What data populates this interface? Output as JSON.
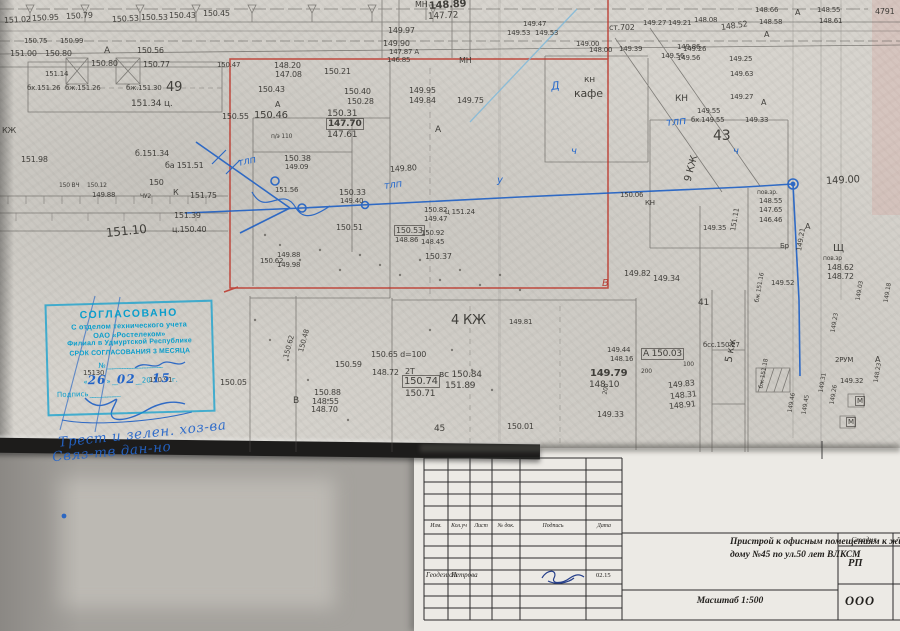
{
  "doc": {
    "type_note": "scanned topographic survey plan 1:500 with approval stamp and title block"
  },
  "stamp": {
    "lines": [
      "СОГЛАСОВАНО",
      "С отделом технического учета",
      "ОАО «Ростелеком»",
      "Филиал в Удмуртской Республике",
      "СРОК СОГЛАСОВАНИЯ 3 МЕСЯЦА"
    ],
    "number_label": "№",
    "date": {
      "open": "«",
      "day": "26",
      "close": "»",
      "month": "02",
      "century": "20",
      "year": "15",
      "suffix": "г."
    },
    "sign_label": "Подпись"
  },
  "notes": [
    {
      "t": "Трест и зелен. хоз-ва",
      "x": 58,
      "y": 426,
      "r": -6
    },
    {
      "t": "Связ-тв  дан-но",
      "x": 52,
      "y": 444,
      "r": -5
    }
  ],
  "titleblock": {
    "columns": [
      "Изм.",
      "Кол.уч",
      "Лист",
      "№ док.",
      "Подпись",
      "Дата"
    ],
    "row": {
      "role": "Геодезист",
      "name": "Петрова",
      "date": "02.15"
    },
    "title_line1": "Пристрой к офисным помещениям к жилому",
    "title_line2": "дому №45 по ул.50 лет ВЛКСМ",
    "scale": "Масштаб 1:500",
    "stage_label": "Стадия",
    "stage_value": "РП",
    "org": "ООО",
    "sheet_col": "Л"
  },
  "map": {
    "labels": [
      {
        "t": "151.02",
        "x": 4,
        "y": 16,
        "r": -3
      },
      {
        "t": "150.95",
        "x": 32,
        "y": 14,
        "r": -3
      },
      {
        "t": "150.79",
        "x": 66,
        "y": 12,
        "r": -3
      },
      {
        "t": "150.53",
        "x": 112,
        "y": 15,
        "r": -3
      },
      {
        "t": "150.53",
        "x": 141,
        "y": 13
      },
      {
        "t": "150.43",
        "x": 169,
        "y": 11
      },
      {
        "t": "150.45",
        "x": 203,
        "y": 9
      },
      {
        "t": "150.75",
        "x": 24,
        "y": 37,
        "s": 7
      },
      {
        "t": "150.99",
        "x": 60,
        "y": 37,
        "s": 7
      },
      {
        "t": "151.00",
        "x": 10,
        "y": 49
      },
      {
        "t": "150.80",
        "x": 45,
        "y": 49
      },
      {
        "t": "А",
        "x": 104,
        "y": 46,
        "s": 9
      },
      {
        "t": "150.56",
        "x": 137,
        "y": 46
      },
      {
        "t": "150.80",
        "x": 91,
        "y": 59
      },
      {
        "t": "150.77",
        "x": 143,
        "y": 60
      },
      {
        "t": "151.14",
        "x": 45,
        "y": 70,
        "s": 7
      },
      {
        "t": "бх.151.26",
        "x": 27,
        "y": 84,
        "s": 7
      },
      {
        "t": "бж.151.26",
        "x": 65,
        "y": 84,
        "s": 7
      },
      {
        "t": "бж.151.30",
        "x": 126,
        "y": 84,
        "s": 7
      },
      {
        "t": "49",
        "x": 166,
        "y": 80,
        "s": 13
      },
      {
        "t": "151.34 ц.",
        "x": 131,
        "y": 99,
        "s": 9
      },
      {
        "t": "КЖ",
        "x": 2,
        "y": 126
      },
      {
        "t": "МН",
        "x": 415,
        "y": 0
      },
      {
        "t": "148.89",
        "x": 429,
        "y": 1,
        "s": 10,
        "w": 1,
        "r": -4
      },
      {
        "t": "147.72",
        "x": 428,
        "y": 12,
        "s": 9,
        "r": -3
      },
      {
        "t": "149.97",
        "x": 388,
        "y": 26
      },
      {
        "t": "149.90",
        "x": 383,
        "y": 39
      },
      {
        "t": "147.87 А",
        "x": 389,
        "y": 48,
        "s": 7
      },
      {
        "t": "146.85",
        "x": 387,
        "y": 56,
        "s": 7
      },
      {
        "t": "МН",
        "x": 459,
        "y": 56
      },
      {
        "t": "149.47",
        "x": 523,
        "y": 20,
        "s": 7
      },
      {
        "t": "149.53",
        "x": 507,
        "y": 29,
        "s": 7
      },
      {
        "t": "149.53",
        "x": 535,
        "y": 29,
        "s": 7
      },
      {
        "t": "ст.702",
        "x": 609,
        "y": 23,
        "s": 8
      },
      {
        "t": "149.00",
        "x": 576,
        "y": 40,
        "s": 7
      },
      {
        "t": "148.00",
        "x": 589,
        "y": 46,
        "s": 7
      },
      {
        "t": "149.39",
        "x": 619,
        "y": 45,
        "s": 7
      },
      {
        "t": "149.86",
        "x": 677,
        "y": 43,
        "s": 7
      },
      {
        "t": "149.56",
        "x": 661,
        "y": 52,
        "s": 7
      },
      {
        "t": "149.27",
        "x": 643,
        "y": 19,
        "s": 7
      },
      {
        "t": "149.21",
        "x": 668,
        "y": 19,
        "s": 7
      },
      {
        "t": "148.08",
        "x": 694,
        "y": 16,
        "s": 7
      },
      {
        "t": "148.52",
        "x": 721,
        "y": 23,
        "r": -8
      },
      {
        "t": "148.58",
        "x": 759,
        "y": 18,
        "s": 7
      },
      {
        "t": "148.66",
        "x": 755,
        "y": 6,
        "s": 7
      },
      {
        "t": "А",
        "x": 795,
        "y": 8
      },
      {
        "t": "148.55",
        "x": 817,
        "y": 6,
        "s": 7
      },
      {
        "t": "148.61",
        "x": 819,
        "y": 17,
        "s": 7
      },
      {
        "t": "4791",
        "x": 875,
        "y": 7
      },
      {
        "t": "149.26",
        "x": 683,
        "y": 45,
        "s": 7
      },
      {
        "t": "149.56",
        "x": 677,
        "y": 54,
        "s": 7
      },
      {
        "t": "А",
        "x": 764,
        "y": 30
      },
      {
        "t": "150.47",
        "x": 217,
        "y": 61,
        "s": 7
      },
      {
        "t": "148.20",
        "x": 274,
        "y": 61
      },
      {
        "t": "147.08",
        "x": 275,
        "y": 70
      },
      {
        "t": "150.21",
        "x": 324,
        "y": 67
      },
      {
        "t": "150.43",
        "x": 258,
        "y": 85
      },
      {
        "t": "150.40",
        "x": 344,
        "y": 87
      },
      {
        "t": "150.28",
        "x": 347,
        "y": 97
      },
      {
        "t": "149.95",
        "x": 409,
        "y": 86
      },
      {
        "t": "149.84",
        "x": 409,
        "y": 96
      },
      {
        "t": "149.75",
        "x": 457,
        "y": 96
      },
      {
        "t": "А",
        "x": 275,
        "y": 100
      },
      {
        "t": "А",
        "x": 435,
        "y": 125,
        "s": 9
      },
      {
        "t": "150.55",
        "x": 222,
        "y": 112
      },
      {
        "t": "150.46",
        "x": 254,
        "y": 110,
        "s": 10
      },
      {
        "t": "150.31",
        "x": 327,
        "y": 109,
        "s": 9
      },
      {
        "t": "147.70",
        "x": 327,
        "y": 119,
        "s": 9,
        "w": 1,
        "b": 1
      },
      {
        "t": "147.61",
        "x": 327,
        "y": 130,
        "s": 9
      },
      {
        "t": "п/э 110",
        "x": 271,
        "y": 133,
        "s": 6
      },
      {
        "t": "150.38",
        "x": 284,
        "y": 154
      },
      {
        "t": "149.09",
        "x": 285,
        "y": 163,
        "s": 7
      },
      {
        "t": "151.56",
        "x": 275,
        "y": 186,
        "s": 7
      },
      {
        "t": "150.33",
        "x": 339,
        "y": 188
      },
      {
        "t": "149.40",
        "x": 340,
        "y": 197,
        "s": 7
      },
      {
        "t": "149.80",
        "x": 390,
        "y": 165,
        "r": -4
      },
      {
        "t": "ц 151.24",
        "x": 445,
        "y": 208,
        "s": 7
      },
      {
        "t": "150.51",
        "x": 336,
        "y": 223
      },
      {
        "t": "150.53",
        "x": 395,
        "y": 226,
        "b": 1
      },
      {
        "t": "148.86",
        "x": 395,
        "y": 236,
        "s": 7
      },
      {
        "t": "150.82",
        "x": 424,
        "y": 206,
        "s": 7
      },
      {
        "t": "149.47",
        "x": 424,
        "y": 215,
        "s": 7
      },
      {
        "t": "150.92",
        "x": 421,
        "y": 229,
        "s": 7
      },
      {
        "t": "148.45",
        "x": 421,
        "y": 238,
        "s": 7
      },
      {
        "t": "150.37",
        "x": 425,
        "y": 252
      },
      {
        "t": "150.62",
        "x": 260,
        "y": 257,
        "s": 7
      },
      {
        "t": "149.88",
        "x": 277,
        "y": 251,
        "s": 7
      },
      {
        "t": "149.98",
        "x": 277,
        "y": 261,
        "s": 7
      },
      {
        "t": "В",
        "x": 602,
        "y": 278,
        "s": 10,
        "c": "red"
      },
      {
        "t": "кн",
        "x": 584,
        "y": 75,
        "s": 9
      },
      {
        "t": "кафе",
        "x": 574,
        "y": 87,
        "s": 11
      },
      {
        "t": "КН",
        "x": 675,
        "y": 94,
        "s": 9
      },
      {
        "t": "149.55",
        "x": 697,
        "y": 107,
        "s": 7
      },
      {
        "t": "бх.149.55",
        "x": 691,
        "y": 116,
        "s": 7
      },
      {
        "t": "149.33",
        "x": 745,
        "y": 116,
        "s": 7
      },
      {
        "t": "43",
        "x": 713,
        "y": 128,
        "s": 14
      },
      {
        "t": "149.63",
        "x": 730,
        "y": 70,
        "s": 7
      },
      {
        "t": "149.27",
        "x": 730,
        "y": 93,
        "s": 7
      },
      {
        "t": "149.25",
        "x": 729,
        "y": 55,
        "s": 7
      },
      {
        "t": "А",
        "x": 761,
        "y": 98
      },
      {
        "t": "9 КЖ",
        "x": 688,
        "y": 176,
        "r": -75,
        "s": 10
      },
      {
        "t": "150.06",
        "x": 620,
        "y": 191,
        "s": 7
      },
      {
        "t": "КН",
        "x": 645,
        "y": 199,
        "s": 7
      },
      {
        "t": "149.35",
        "x": 703,
        "y": 224,
        "s": 7
      },
      {
        "t": "пов.зр.",
        "x": 757,
        "y": 189,
        "s": 6
      },
      {
        "t": "148.55",
        "x": 759,
        "y": 197,
        "s": 7
      },
      {
        "t": "147.65",
        "x": 759,
        "y": 206,
        "s": 7
      },
      {
        "t": "146.46",
        "x": 759,
        "y": 216,
        "s": 7
      },
      {
        "t": "149.00",
        "x": 826,
        "y": 176,
        "s": 10,
        "r": -3
      },
      {
        "t": "151.11",
        "x": 733,
        "y": 227,
        "r": -80,
        "s": 7
      },
      {
        "t": "Бр",
        "x": 780,
        "y": 242,
        "s": 7
      },
      {
        "t": "149.21",
        "x": 799,
        "y": 247,
        "r": -80,
        "s": 7
      },
      {
        "t": "А",
        "x": 805,
        "y": 222
      },
      {
        "t": "Щ",
        "x": 833,
        "y": 243,
        "s": 10
      },
      {
        "t": "пов.зр",
        "x": 823,
        "y": 255,
        "s": 6
      },
      {
        "t": "148.62",
        "x": 827,
        "y": 263
      },
      {
        "t": "148.72",
        "x": 827,
        "y": 272
      },
      {
        "t": "149.82",
        "x": 624,
        "y": 269
      },
      {
        "t": "149.34",
        "x": 653,
        "y": 274
      },
      {
        "t": "149.52",
        "x": 771,
        "y": 279,
        "s": 7
      },
      {
        "t": "4 КЖ",
        "x": 451,
        "y": 313,
        "s": 13
      },
      {
        "t": "149.81",
        "x": 509,
        "y": 318,
        "s": 7
      },
      {
        "t": "вс 150.84",
        "x": 439,
        "y": 370,
        "s": 9
      },
      {
        "t": "151.89",
        "x": 445,
        "y": 381,
        "s": 9
      },
      {
        "t": "150.65 d=100",
        "x": 371,
        "y": 350
      },
      {
        "t": "148.72",
        "x": 372,
        "y": 368
      },
      {
        "t": "2Т",
        "x": 405,
        "y": 367
      },
      {
        "t": "150.74",
        "x": 403,
        "y": 376,
        "s": 10,
        "b": 1
      },
      {
        "t": "150.71",
        "x": 405,
        "y": 389,
        "s": 9
      },
      {
        "t": "150.59",
        "x": 335,
        "y": 360
      },
      {
        "t": "150.88",
        "x": 314,
        "y": 388
      },
      {
        "t": "148.55",
        "x": 312,
        "y": 397
      },
      {
        "t": "148.70",
        "x": 311,
        "y": 405
      },
      {
        "t": "150.62",
        "x": 286,
        "y": 354,
        "r": -75,
        "s": 7
      },
      {
        "t": "150.48",
        "x": 301,
        "y": 348,
        "r": -75,
        "s": 7
      },
      {
        "t": "В",
        "x": 293,
        "y": 396,
        "s": 9
      },
      {
        "t": "150.05",
        "x": 220,
        "y": 378
      },
      {
        "t": "45",
        "x": 434,
        "y": 424,
        "s": 9
      },
      {
        "t": "150.01",
        "x": 507,
        "y": 422
      },
      {
        "t": "149.79",
        "x": 590,
        "y": 368,
        "s": 10,
        "w": 1
      },
      {
        "t": "148.10",
        "x": 589,
        "y": 380,
        "s": 9
      },
      {
        "t": "149.44",
        "x": 607,
        "y": 346,
        "s": 7
      },
      {
        "t": "148.16",
        "x": 610,
        "y": 355,
        "s": 7
      },
      {
        "t": "А 150.03",
        "x": 642,
        "y": 349,
        "s": 9,
        "b": 1
      },
      {
        "t": "200",
        "x": 641,
        "y": 368,
        "s": 6
      },
      {
        "t": "100",
        "x": 683,
        "y": 361,
        "s": 6
      },
      {
        "t": "149.83",
        "x": 668,
        "y": 381,
        "r": -6
      },
      {
        "t": "148.31",
        "x": 670,
        "y": 392,
        "r": -6
      },
      {
        "t": "148.91",
        "x": 669,
        "y": 402,
        "r": -6
      },
      {
        "t": "149.33",
        "x": 597,
        "y": 410
      },
      {
        "t": "200",
        "x": 605,
        "y": 391,
        "r": -80,
        "s": 6
      },
      {
        "t": "бсс.150.27",
        "x": 703,
        "y": 341,
        "s": 7
      },
      {
        "t": "41",
        "x": 698,
        "y": 298,
        "s": 9
      },
      {
        "t": "5 кж",
        "x": 729,
        "y": 357,
        "r": -80,
        "s": 10
      },
      {
        "t": "бж 151.16",
        "x": 757,
        "y": 299,
        "r": -80,
        "s": 6
      },
      {
        "t": "бж 151.18",
        "x": 761,
        "y": 385,
        "r": -80,
        "s": 6
      },
      {
        "t": "149.46",
        "x": 790,
        "y": 409,
        "r": -80,
        "s": 6
      },
      {
        "t": "149.45",
        "x": 804,
        "y": 411,
        "r": -80,
        "s": 6
      },
      {
        "t": "149.31",
        "x": 821,
        "y": 389,
        "r": -80,
        "s": 6
      },
      {
        "t": "149.26",
        "x": 832,
        "y": 401,
        "r": -80,
        "s": 6
      },
      {
        "t": "149.32",
        "x": 840,
        "y": 377,
        "s": 7
      },
      {
        "t": "2РУМ",
        "x": 835,
        "y": 356,
        "s": 7
      },
      {
        "t": "149.23",
        "x": 833,
        "y": 329,
        "r": -80,
        "s": 6
      },
      {
        "t": "148.23",
        "x": 876,
        "y": 379,
        "r": -80,
        "s": 6
      },
      {
        "t": "А",
        "x": 875,
        "y": 355
      },
      {
        "t": "М",
        "x": 856,
        "y": 397,
        "s": 7,
        "b": 1
      },
      {
        "t": "М",
        "x": 847,
        "y": 418,
        "s": 7,
        "b": 1
      },
      {
        "t": "149.03",
        "x": 858,
        "y": 297,
        "r": -80,
        "s": 6
      },
      {
        "t": "149.18",
        "x": 886,
        "y": 299,
        "r": -80,
        "s": 6
      },
      {
        "t": "151.98",
        "x": 21,
        "y": 155
      },
      {
        "t": "б.151.34",
        "x": 135,
        "y": 149
      },
      {
        "t": "ба 151.51",
        "x": 165,
        "y": 161
      },
      {
        "t": "150 ВЧ",
        "x": 59,
        "y": 182,
        "s": 6
      },
      {
        "t": "150.12",
        "x": 87,
        "y": 182,
        "s": 6
      },
      {
        "t": "149.88",
        "x": 92,
        "y": 191,
        "s": 7
      },
      {
        "t": "150",
        "x": 149,
        "y": 178
      },
      {
        "t": "ЧУ2",
        "x": 140,
        "y": 193,
        "s": 6
      },
      {
        "t": "К",
        "x": 173,
        "y": 188
      },
      {
        "t": "151.75",
        "x": 190,
        "y": 191
      },
      {
        "t": "151.39",
        "x": 174,
        "y": 211
      },
      {
        "t": "ц.150.40",
        "x": 172,
        "y": 225
      },
      {
        "t": "151.10",
        "x": 106,
        "y": 226,
        "s": 12,
        "r": -6
      },
      {
        "t": "15130",
        "x": 83,
        "y": 369,
        "s": 7
      },
      {
        "t": "150.91",
        "x": 149,
        "y": 376,
        "s": 7
      },
      {
        "t": "тлп",
        "x": 238,
        "y": 158,
        "c": "blue",
        "s": 10,
        "r": -12
      },
      {
        "t": "тлп",
        "x": 384,
        "y": 181,
        "c": "blue",
        "s": 10,
        "r": -8
      },
      {
        "t": "тлп",
        "x": 666,
        "y": 116,
        "c": "blue",
        "s": 11,
        "r": -6
      },
      {
        "t": "ч",
        "x": 571,
        "y": 146,
        "c": "blue",
        "s": 10
      },
      {
        "t": "ч",
        "x": 733,
        "y": 146,
        "c": "blue",
        "s": 10
      },
      {
        "t": "у",
        "x": 497,
        "y": 175,
        "c": "blue",
        "s": 10
      },
      {
        "t": "Д",
        "x": 551,
        "y": 80,
        "c": "blue",
        "s": 11,
        "r": -8
      }
    ]
  }
}
